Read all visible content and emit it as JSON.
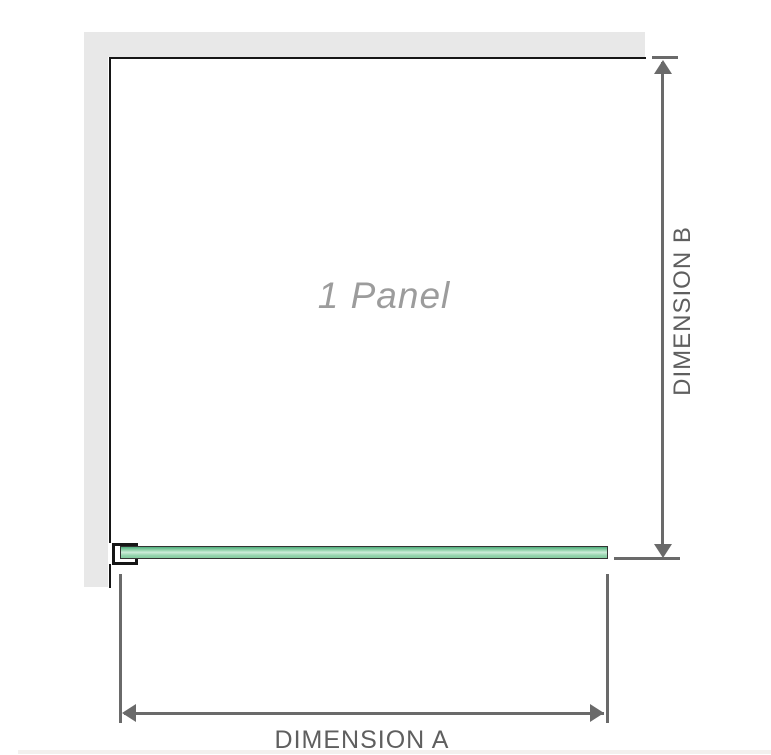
{
  "diagram": {
    "panel_label": "1 Panel",
    "dimension_a": {
      "label": "DIMENSION A"
    },
    "dimension_b": {
      "label": "DIMENSION B"
    }
  },
  "colors": {
    "wall": "#e8e8e8",
    "outline": "#161616",
    "dimension": "#6a6a6a",
    "label": "#5f5f5f",
    "panel_text": "#9c9c9c",
    "glass_dark": "#4fae7d",
    "glass_mid": "#93d3ac",
    "glass_light": "#cdecd9"
  }
}
